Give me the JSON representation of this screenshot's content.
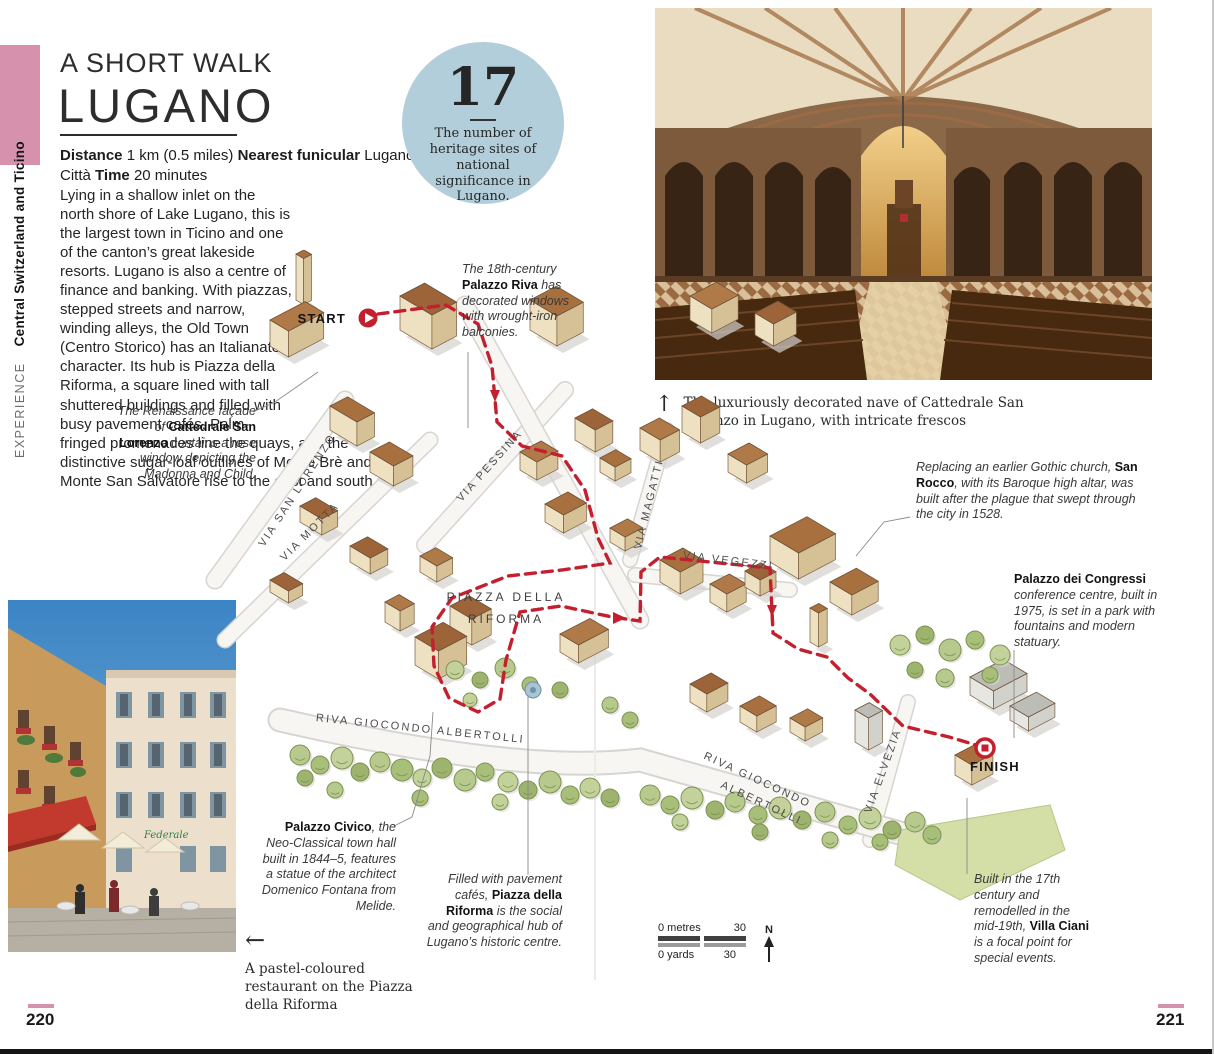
{
  "sidebar": {
    "eyebrow": "EXPERIENCE",
    "chapter": "Central Switzerland and Ticino"
  },
  "header": {
    "kicker": "A SHORT WALK",
    "title": "LUGANO"
  },
  "meta": {
    "distance_label": "Distance",
    "distance_value": "1 km (0.5 miles)",
    "funicular_label": "Nearest funicular",
    "funicular_value": "Lugano Città",
    "time_label": "Time",
    "time_value": "20 minutes"
  },
  "intro": "Lying in a shallow inlet on the north shore of Lake Lugano, this is the largest town in Ticino and one of the canton’s great lakeside resorts. Lugano is also a centre of finance and banking. With piazzas, stepped streets and narrow, winding alleys, the Old Town (Centro Storico) has an Italianate character. Its hub is Piazza della Riforma, a square lined with tall shuttered buildings and filled with busy pavement cafés. Palm-fringed promenades line the quays, and the distinctive sugar-loaf outlines of Monte Brè and Monte San Salvatore rise to the east and south.",
  "stat": {
    "number": "17",
    "caption": "The number of heritage sites of national significance in Lugano."
  },
  "photos": {
    "cathedral_caption": "The luxuriously decorated nave of Cattedrale San Lorenzo in Lugano, with intricate frescos",
    "restaurant_caption": "A pastel-coloured restaurant on the Piazza della Riforma",
    "restaurant_sign": "Federale"
  },
  "map": {
    "start": "START",
    "finish": "FINISH",
    "streets": {
      "san_lorenzo": "VIA SAN LORENZO",
      "motta": "VIA MOTTA",
      "pessina": "VIA PESSINA",
      "magatti": "VIA MAGATTI",
      "vegezzi": "VIA VEGEZZI",
      "piazza_line1": "PIAZZA DELLA",
      "piazza_line2": "RIFORMA",
      "riva_left": "RIVA GIOCONDO ALBERTOLLI",
      "riva_right_line1": "RIVA GIOCONDO",
      "riva_right_line2": "ALBERTOLLI",
      "elvezia": "VIA ELVEZIA"
    },
    "scale": {
      "metres": "0 metres",
      "metres_max": "30",
      "yards": "0 yards",
      "yards_max": "30",
      "north": "N"
    }
  },
  "annotations": {
    "palazzo_riva": {
      "pre": "The 18th-century ",
      "name": "Palazzo Riva",
      "post": " has decorated windows with wrought-iron balconies."
    },
    "cattedrale": {
      "pre": "The Renaissance façade of ",
      "name": "Cattedrale San Lorenzo",
      "post": " contains a rose window depicting the Madonna and Child."
    },
    "san_rocco": {
      "pre": "Replacing an earlier Gothic church, ",
      "name": "San Rocco",
      "post": ", with its Baroque high altar, was built after the plague that swept through the city in 1528."
    },
    "congressi": {
      "pre": "",
      "name": "Palazzo dei Congressi",
      "post": " conference centre, built in 1975, is set in a park with fountains and modern statuary."
    },
    "civico": {
      "pre": "",
      "name": "Palazzo Civico",
      "post": ", the Neo-Classical town hall built in 1844–5, features a statue of the architect Domenico Fontana from Melide."
    },
    "riforma": {
      "pre": "Filled with pavement cafés, ",
      "name": "Piazza della Riforma",
      "post": " is the social and geographical hub of Lugano’s historic centre."
    },
    "villa_ciani": {
      "pre": "Built in the 17th century and remodelled in the mid-19th, ",
      "name": "Villa Ciani",
      "post": " is a focal point for special events."
    }
  },
  "footer": {
    "left_page": "220",
    "right_page": "221"
  },
  "colors": {
    "accent_pink": "#d691ad",
    "badge_blue": "#b3cedb",
    "route_red": "#c41f2e"
  }
}
